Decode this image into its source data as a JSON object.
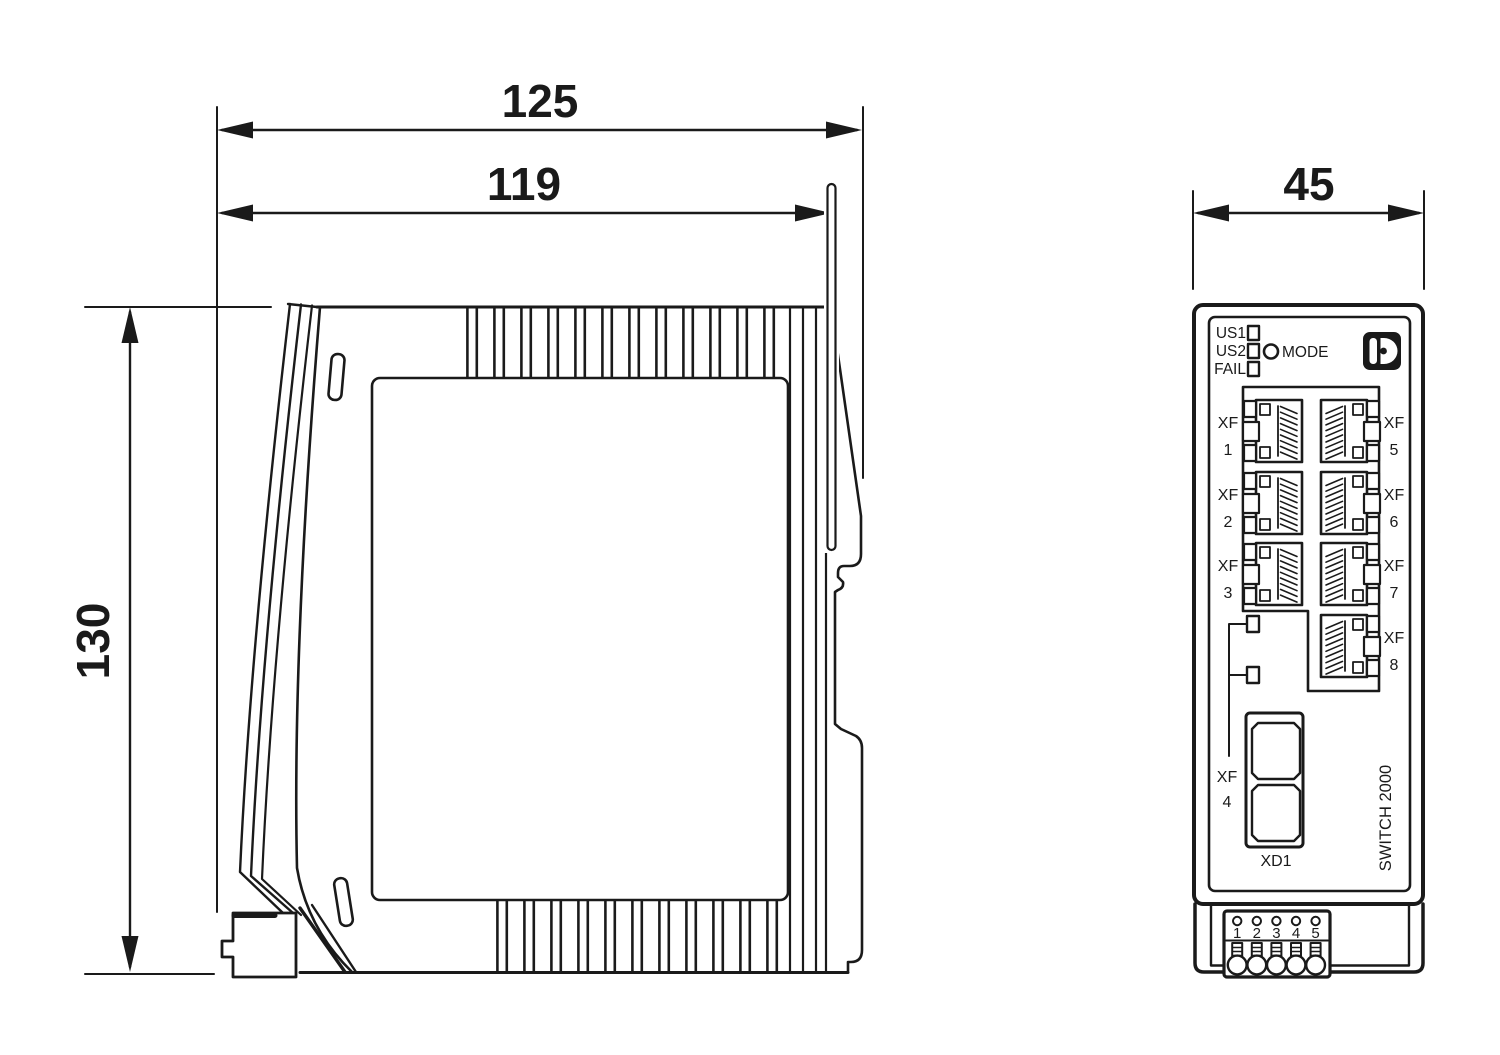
{
  "drawing": {
    "side_view": {
      "dim_overall_width": "125",
      "dim_body_width": "119",
      "dim_height": "130"
    },
    "front_view": {
      "dim_width": "45",
      "leds": [
        {
          "label": "US1"
        },
        {
          "label": "US2"
        },
        {
          "label": "FAIL"
        }
      ],
      "mode_label": "MODE",
      "logo_icon": "phoenix-contact-logo",
      "ports_left": [
        {
          "prefix": "XF",
          "number": "1"
        },
        {
          "prefix": "XF",
          "number": "2"
        },
        {
          "prefix": "XF",
          "number": "3"
        }
      ],
      "ports_right": [
        {
          "prefix": "XF",
          "number": "5"
        },
        {
          "prefix": "XF",
          "number": "6"
        },
        {
          "prefix": "XF",
          "number": "7"
        },
        {
          "prefix": "XF",
          "number": "8"
        }
      ],
      "port_xf4": {
        "prefix": "XF",
        "number": "4"
      },
      "combo_port_label": "XD1",
      "model_label": "SWITCH 2000",
      "terminals": [
        "1",
        "2",
        "3",
        "4",
        "5"
      ]
    },
    "colors": {
      "line": "#1a1a1a",
      "background": "#ffffff"
    }
  }
}
